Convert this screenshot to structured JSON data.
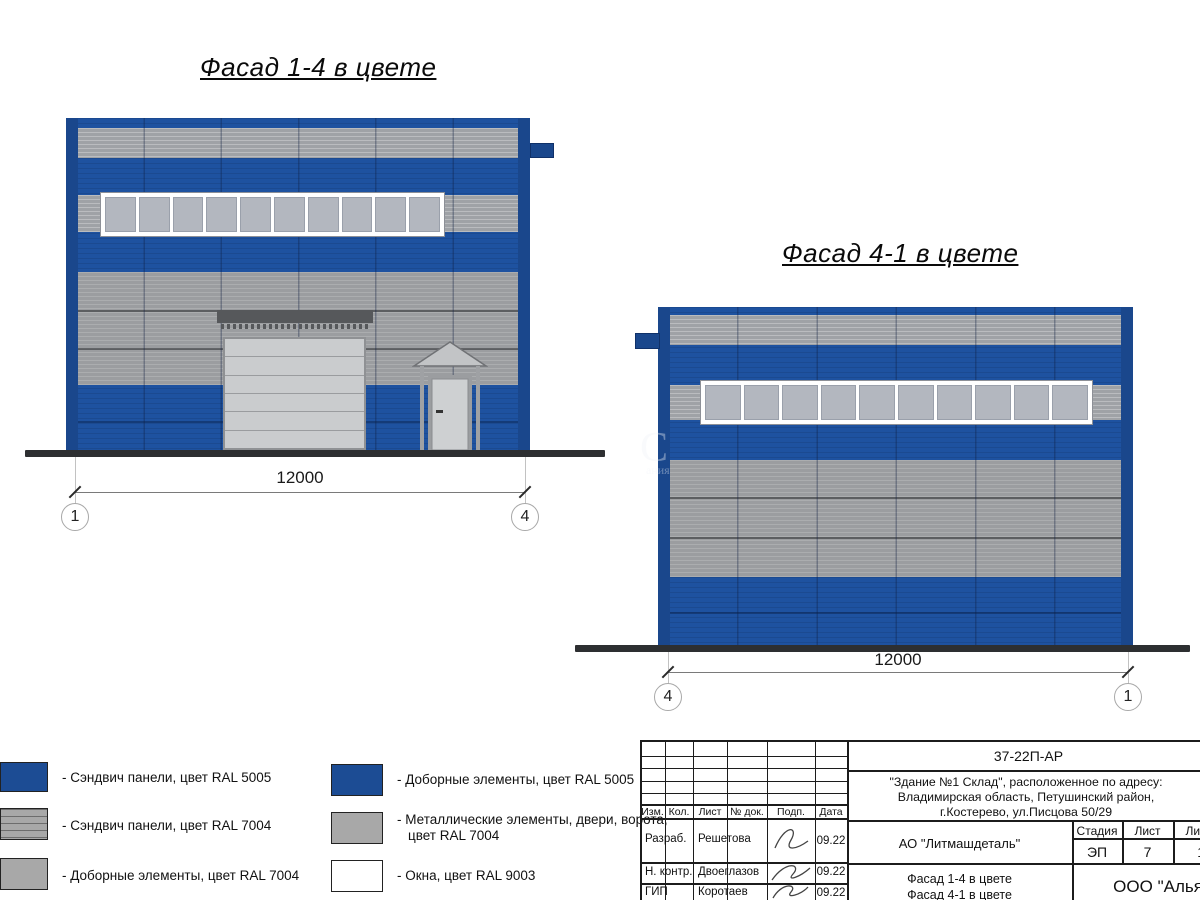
{
  "facade_left": {
    "title": "Фасад 1-4 в цвете",
    "dimension": "12000",
    "axis_left": "1",
    "axis_right": "4"
  },
  "facade_right": {
    "title": "Фасад 4-1 в цвете",
    "dimension": "12000",
    "axis_left": "4",
    "axis_right": "1"
  },
  "legend": {
    "items": [
      {
        "swatch": "blue-sandwich-panel",
        "label": "- Сэндвич панели, цвет RAL 5005"
      },
      {
        "swatch": "gray-sandwich-panel",
        "label": "- Сэндвич панели, цвет RAL 7004"
      },
      {
        "swatch": "gray-trim-elements",
        "label": "- Доборные элементы, цвет RAL 7004"
      },
      {
        "swatch": "blue-trim-elements",
        "label": "- Доборные элементы, цвет RAL 5005"
      },
      {
        "swatch": "gray-metal-elements",
        "label": "- Металлические элементы, двери, ворота,\nцвет RAL 7004"
      },
      {
        "swatch": "white-windows",
        "label": "- Окна, цвет RAL 9003"
      }
    ]
  },
  "title_block": {
    "doc_number": "37-22П-АР",
    "address_lines": [
      "\"Здание №1 Склад\", расположенное по адресу:",
      "Владимирская область, Петушинский район,",
      "г.Костерево, ул.Писцова 50/29"
    ],
    "columns": [
      "Изм.",
      "Кол.",
      "Лист",
      "№ док.",
      "Подп.",
      "Дата"
    ],
    "rows": [
      {
        "role": "Разраб.",
        "name": "Решетова",
        "date": "09.22"
      },
      {
        "role": "Н. контр.",
        "name": "Двоеглазов",
        "date": "09.22"
      },
      {
        "role": "ГИП",
        "name": "Коротаев",
        "date": "09.22"
      }
    ],
    "client": "АО \"Литмашдеталь\"",
    "stage_label": "Стадия",
    "sheet_label": "Лист",
    "sheets_label": "Листов",
    "stage": "ЭП",
    "sheet": "7",
    "sheets": "14",
    "drawing_title_line1": "Фасад 1-4 в цвете",
    "drawing_title_line2": "Фасад 4-1 в цвете",
    "organization": "ООО \"Альянс"
  },
  "watermark": {
    "big": "С",
    "small": "ания"
  },
  "colors": {
    "c-blue": "#1e52a0",
    "c-bluedark": "#1a478c",
    "c-grayband": "#9fa2a6",
    "c-graybig": "#9b9da0",
    "c-glass": "#b3b7bf",
    "c-white": "#ffffff",
    "c-ground": "#2d2f31",
    "c-metal": "#56585b",
    "c-doorleaf": "#caccce",
    "c-legendblue": "#1c4c94",
    "c-legendgray": "#a8a8a8",
    "c-line": "#1c1c1c"
  }
}
